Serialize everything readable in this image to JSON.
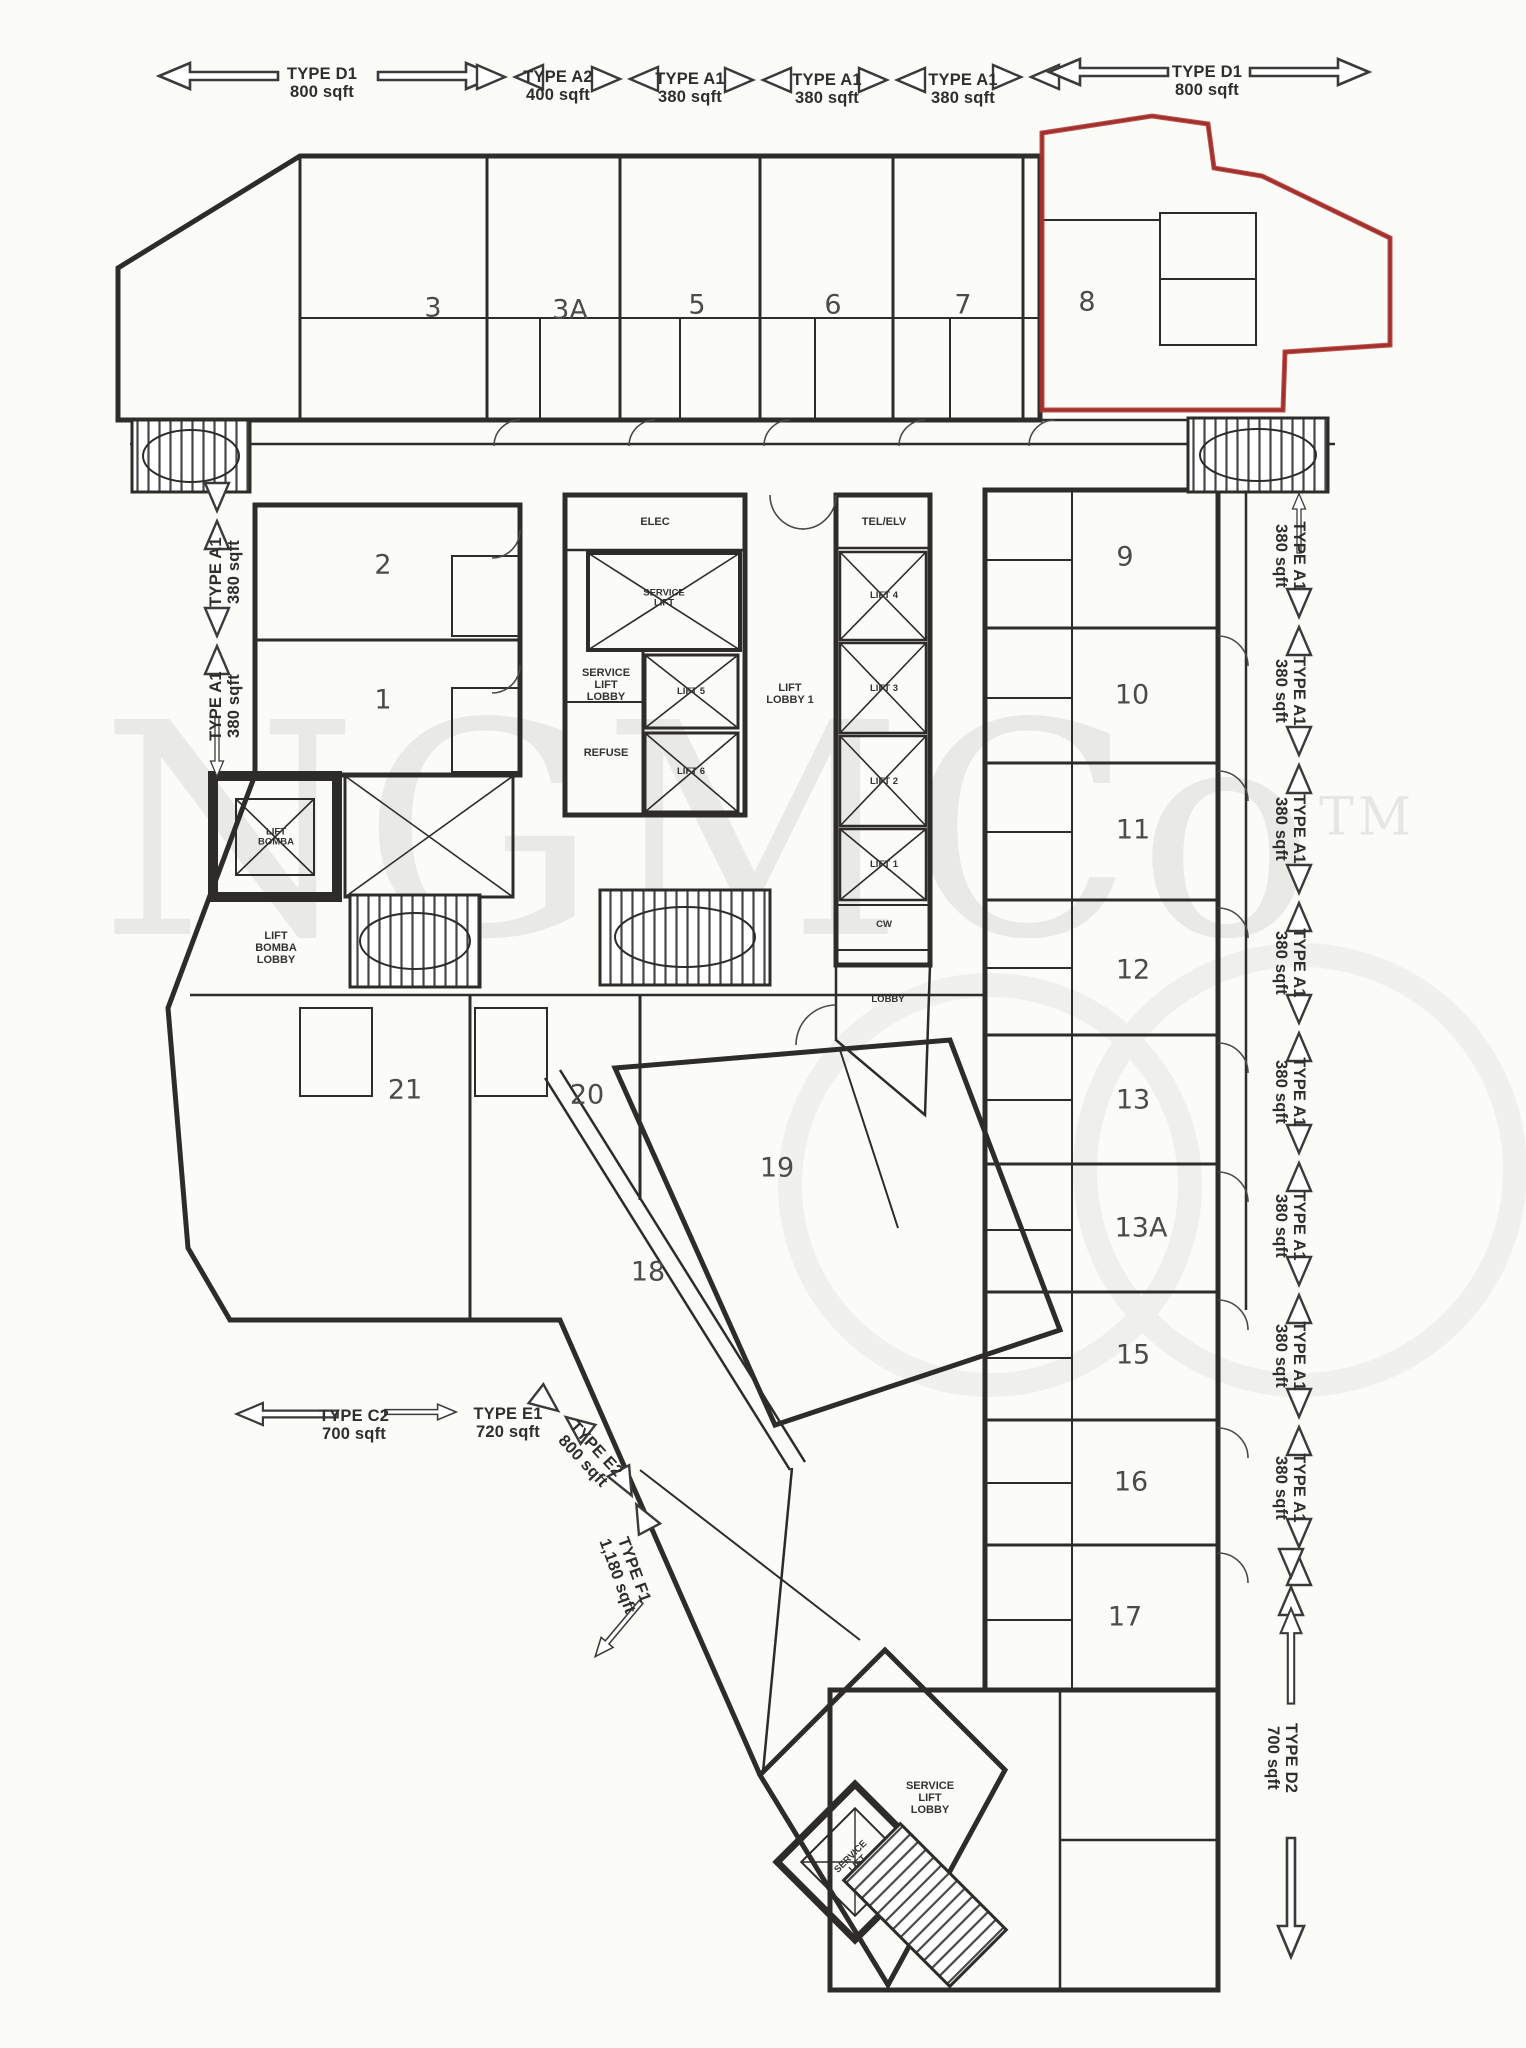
{
  "watermark": {
    "text": "NGMCo",
    "tm": "TM"
  },
  "colors": {
    "highlight": "#b5322e"
  },
  "legend": {
    "top": [
      {
        "type": "TYPE D1",
        "area": "800 sqft"
      },
      {
        "type": "TYPE A2",
        "area": "400 sqft"
      },
      {
        "type": "TYPE A1",
        "area": "380 sqft"
      },
      {
        "type": "TYPE A1",
        "area": "380 sqft"
      },
      {
        "type": "TYPE A1",
        "area": "380 sqft"
      },
      {
        "type": "TYPE D1",
        "area": "800 sqft"
      }
    ],
    "left": [
      {
        "type": "TYPE A1",
        "area": "380 sqft"
      },
      {
        "type": "TYPE A1",
        "area": "380 sqft"
      }
    ],
    "right": [
      {
        "type": "TYPE A1",
        "area": "380 sqft"
      },
      {
        "type": "TYPE A1",
        "area": "380 sqft"
      },
      {
        "type": "TYPE A1",
        "area": "380 sqft"
      },
      {
        "type": "TYPE A1",
        "area": "380 sqft"
      },
      {
        "type": "TYPE A1",
        "area": "380 sqft"
      },
      {
        "type": "TYPE A1",
        "area": "380 sqft"
      },
      {
        "type": "TYPE A1",
        "area": "380 sqft"
      },
      {
        "type": "TYPE A1",
        "area": "380 sqft"
      }
    ],
    "right_bottom": {
      "type": "TYPE D2",
      "area": "700 sqft"
    },
    "bottom": [
      {
        "type": "TYPE C2",
        "area": "700 sqft"
      },
      {
        "type": "TYPE E1",
        "area": "720 sqft"
      },
      {
        "type": "TYPE E2",
        "area": "800 sqft"
      },
      {
        "type": "TYPE F1",
        "area": "1,180 sqft"
      }
    ]
  },
  "units": {
    "top": [
      "3",
      "3A",
      "5",
      "6",
      "7",
      "8"
    ],
    "left": [
      "2",
      "1"
    ],
    "right": [
      "9",
      "10",
      "11",
      "12",
      "13",
      "13A",
      "15",
      "16",
      "17"
    ],
    "bottom": [
      "21",
      "20",
      "19",
      "18"
    ]
  },
  "core": {
    "elec": "ELEC",
    "tel": "TEL/ELV",
    "service_lift": "SERVICE\nLIFT",
    "service_lift_lobby": "SERVICE\nLIFT\nLOBBY",
    "refuse": "REFUSE",
    "lift_lobby": "LIFT\nLOBBY 1",
    "lifts_left": [
      "LIFT 5",
      "LIFT 6"
    ],
    "lifts_right": [
      "LIFT 4",
      "LIFT 3",
      "LIFT 2",
      "LIFT 1"
    ],
    "lift_bomba": "LIFT\nBOMBA",
    "lift_bomba_lobby": "LIFT\nBOMBA\nLOBBY",
    "cw": "CW",
    "lobby": "LOBBY",
    "service_lift_bottom": "SERVICE\nLIFT",
    "service_lift_lobby_bottom": "SERVICE\nLIFT\nLOBBY"
  }
}
